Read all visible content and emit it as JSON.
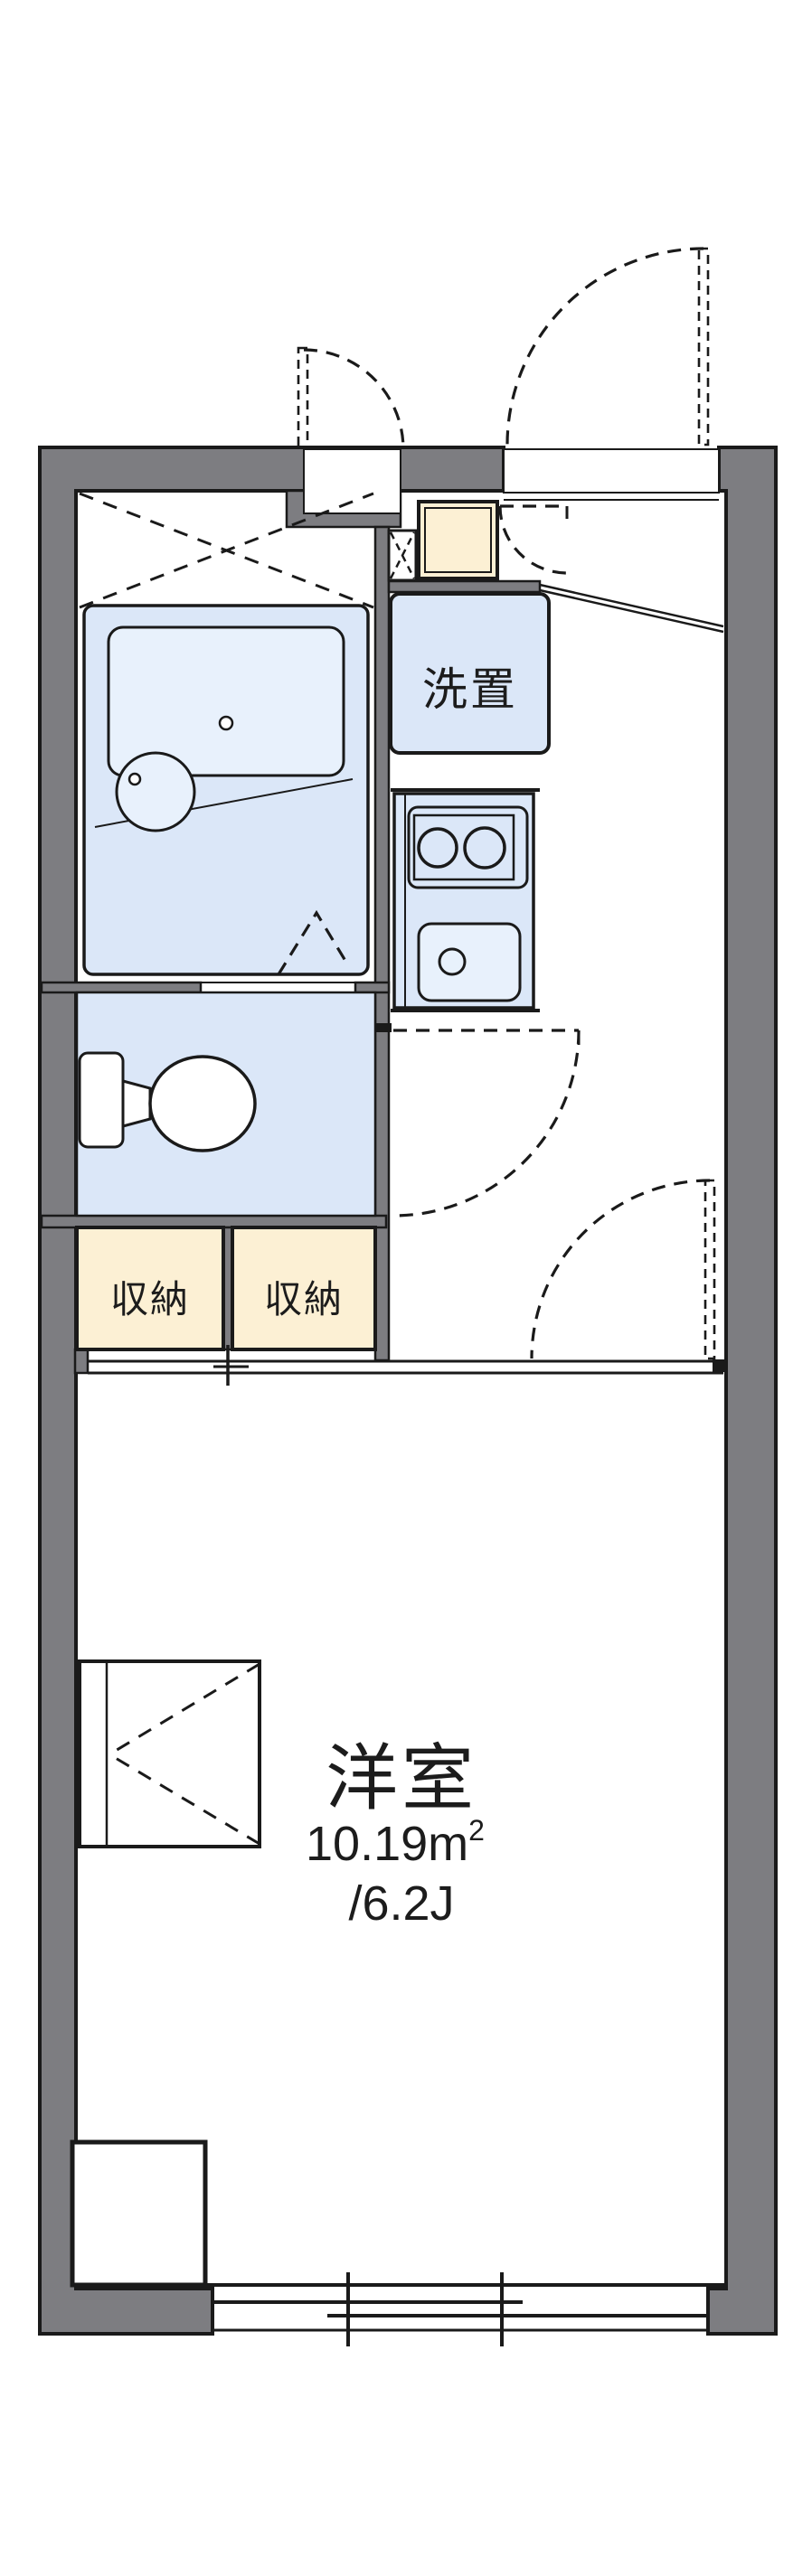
{
  "plan": {
    "type": "apartment-floor-plan",
    "colors": {
      "wall_gray": "#7d7d81",
      "line_black": "#1a1a1a",
      "fixture_blue": "#dbe7f8",
      "fixture_blue_light": "#e8f1fc",
      "storage_cream": "#fcf0d4",
      "background": "#ffffff",
      "text": "#1c1c1c"
    },
    "labels": {
      "washer_place": "洗置",
      "storage_left": "収納",
      "storage_right": "収納"
    },
    "room": {
      "name": "洋室",
      "area_value": "10.19",
      "area_unit": "m",
      "area_sup": "2",
      "tatami": "/6.2J"
    },
    "icons": [
      "bathtub-icon",
      "washbasin-icon",
      "toilet-icon",
      "stove-icon",
      "sink-icon",
      "entrance-door-swing-icon",
      "meter-box-door-swing-icon",
      "cabinet-door-swing-icon",
      "hall-door-swing-icon",
      "room-door-swing-icon",
      "bath-folding-door-icon",
      "ceiling-hatch-x-icon",
      "pipe-space-x-icon",
      "sliding-window-icon",
      "sliding-door-track-icon",
      "folding-bed-icon",
      "counter-desk-icon"
    ]
  }
}
